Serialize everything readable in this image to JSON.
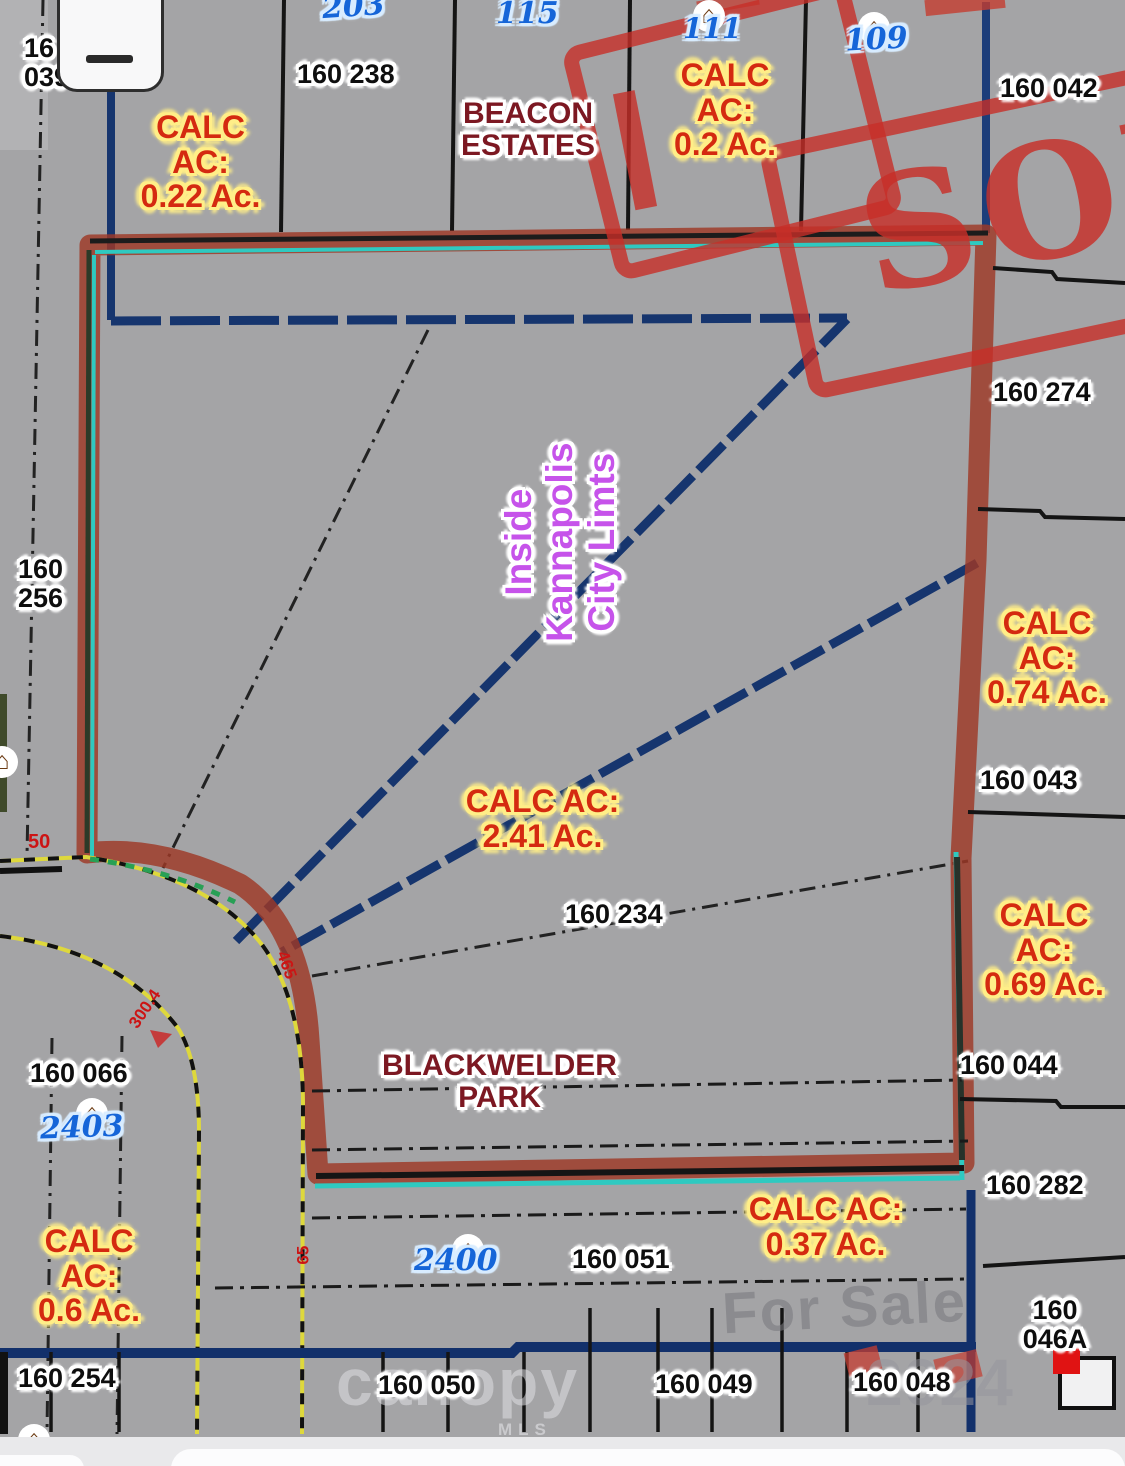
{
  "ui": {
    "icons": {
      "zoom_out": "−"
    }
  },
  "watermark": {
    "for_sale": "For Sale",
    "brand": "canopy",
    "year": "2024",
    "mls": "MLS"
  },
  "map": {
    "icons": {
      "house": "⌂"
    },
    "region_labels": {
      "beacon": "BEACON\nESTATES",
      "blackwelder": "BLACKWELDER\nPARK",
      "city_limits": "Inside\nKannapolis\nCity Limts"
    },
    "parcel_ids": {
      "p039": "16\n039",
      "p238": "160 238",
      "p042": "160 042",
      "p274": "160 274",
      "p256": "160\n256",
      "p043": "160 043",
      "p234": "160 234",
      "p044": "160 044",
      "p282": "160 282",
      "p066": "160 066",
      "p051": "160 051",
      "p046a": "160\n046A",
      "p254": "160 254",
      "p050": "160 050",
      "p049": "160 049",
      "p048": "160 048"
    },
    "street_numbers": {
      "n203": "203",
      "n115": "115",
      "n111": "111",
      "n109": "109",
      "n2403": "2403",
      "n2400": "2400"
    },
    "calc_acres": {
      "c022": "CALC\nAC:\n0.22 Ac.",
      "c02": "CALC\nAC:\n0.2 Ac.",
      "c074": "CALC\nAC:\n0.74 Ac.",
      "c241": "CALC AC:\n2.41 Ac.",
      "c069": "CALC\nAC:\n0.69 Ac.",
      "c037": "CALC AC:\n0.37 Ac.",
      "c06": "CALC\nAC:\n0.6 Ac."
    },
    "dimensions": {
      "d50": "50",
      "d465": "465",
      "d300_4": "300.4",
      "d65": "65"
    },
    "stamp": {
      "text": "SOLD"
    },
    "colors": {
      "background_gray": "#a4a4a6",
      "highlight_red": "#9e3826",
      "parcel_teal": "#2fc9c0",
      "city_limit_navy": "#16356e",
      "road_yellow": "#ded83c",
      "calc_text_red": "#d42a10",
      "calc_halo_yellow": "#ffee88",
      "street_number_blue": "#1565d8",
      "region_label_red": "#7c1822",
      "city_limits_purple": "#c653ea",
      "stamp_red": "#c72e28"
    }
  }
}
